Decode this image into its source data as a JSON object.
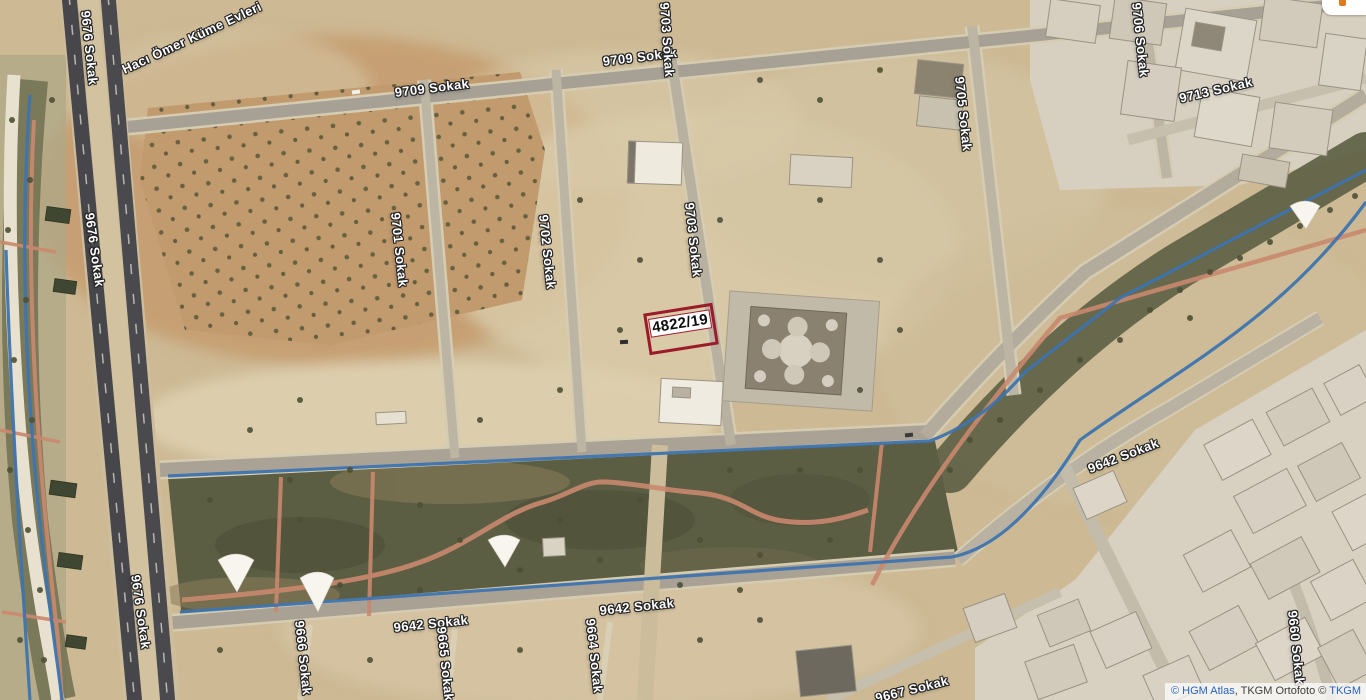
{
  "map": {
    "parcel_label": "4822/19",
    "street_labels": {
      "haci": "Hacı Ömer Küme Evleri",
      "s9709": "9709 Sokak",
      "s9701": "9701 Sokak",
      "s9702": "9702 Sokak",
      "s9703": "9703 Sokak",
      "s9705": "9705 Sokak",
      "s9706": "9706 Sokak",
      "s9713": "9713 Sokak",
      "s9676": "9676 Sokak",
      "s9642": "9642 Sokak",
      "s9660": "9660 Sokak",
      "s9664": "9664 Sokak",
      "s9665": "9665 Sokak",
      "s9666": "9666 Sokak",
      "s9667": "9667 Sokak"
    }
  },
  "attribution": {
    "part1": "© HGM Atlas",
    "part2": ", TKGM Ortofoto © ",
    "part3": "TKGM"
  },
  "colors": {
    "parcel_outline": "#9c1b2a",
    "attribution_link": "#2563c4",
    "path_blue": "#3e74ae",
    "path_pink": "#c9886e",
    "park_green": "#5c5e44",
    "ground_tan": "#cdb994"
  }
}
